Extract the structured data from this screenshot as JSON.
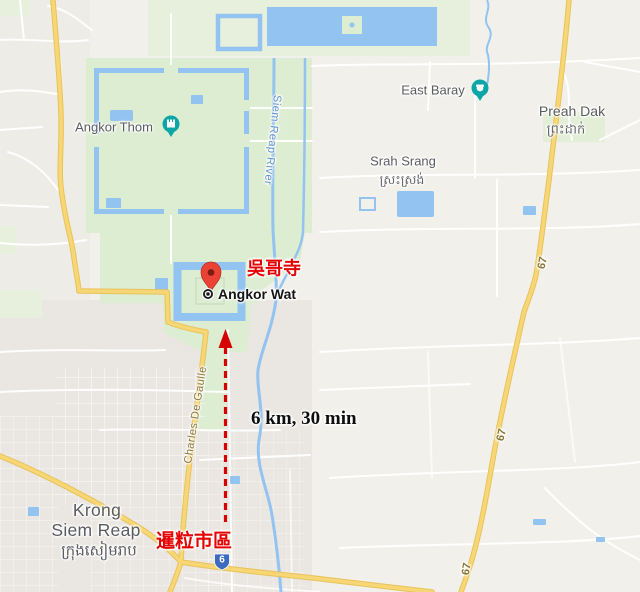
{
  "map": {
    "labels": {
      "angkor_thom": "Angkor Thom",
      "east_baray": "East Baray",
      "preah_dak": "Preah Dak",
      "preah_dak_khmer": "ព្រះដាក់",
      "srah_srang": "Srah Srang",
      "srah_srang_khmer": "ស្រះស្រង់",
      "angkor_wat": "Angkor Wat",
      "krong_line1": "Krong",
      "krong_line2": "Siem Reap",
      "krong_khmer": "ក្រុងសៀមរាប",
      "siem_reap_river": "Siem Reap River",
      "charles_de_gaulle": "Charles De Gaulle"
    },
    "route_labels": {
      "r67": "67",
      "r6": "6"
    },
    "annotations": {
      "angkor_wat_chinese": "吳哥寺",
      "siem_reap_downtown_chinese": "暹粒市區",
      "distance": "6 km, 30 min"
    },
    "colors": {
      "land": "#f2f0ea",
      "urban": "#eae6e1",
      "park_green": "#dcedd2",
      "pale_green": "#e6f0dc",
      "water": "#93c3f0",
      "road_yellow": "#f7d675",
      "road_casing": "#e8c35c",
      "annotation_red": "#e60202",
      "arrow_red": "#d60000",
      "pin_red": "#ea4335",
      "pin_teal": "#0ca6a6",
      "route6_shield_blue": "#3b6abf",
      "label_gray": "#5f6368",
      "water_label_blue": "#5e92c9",
      "road_label_brown": "#86763f"
    }
  }
}
